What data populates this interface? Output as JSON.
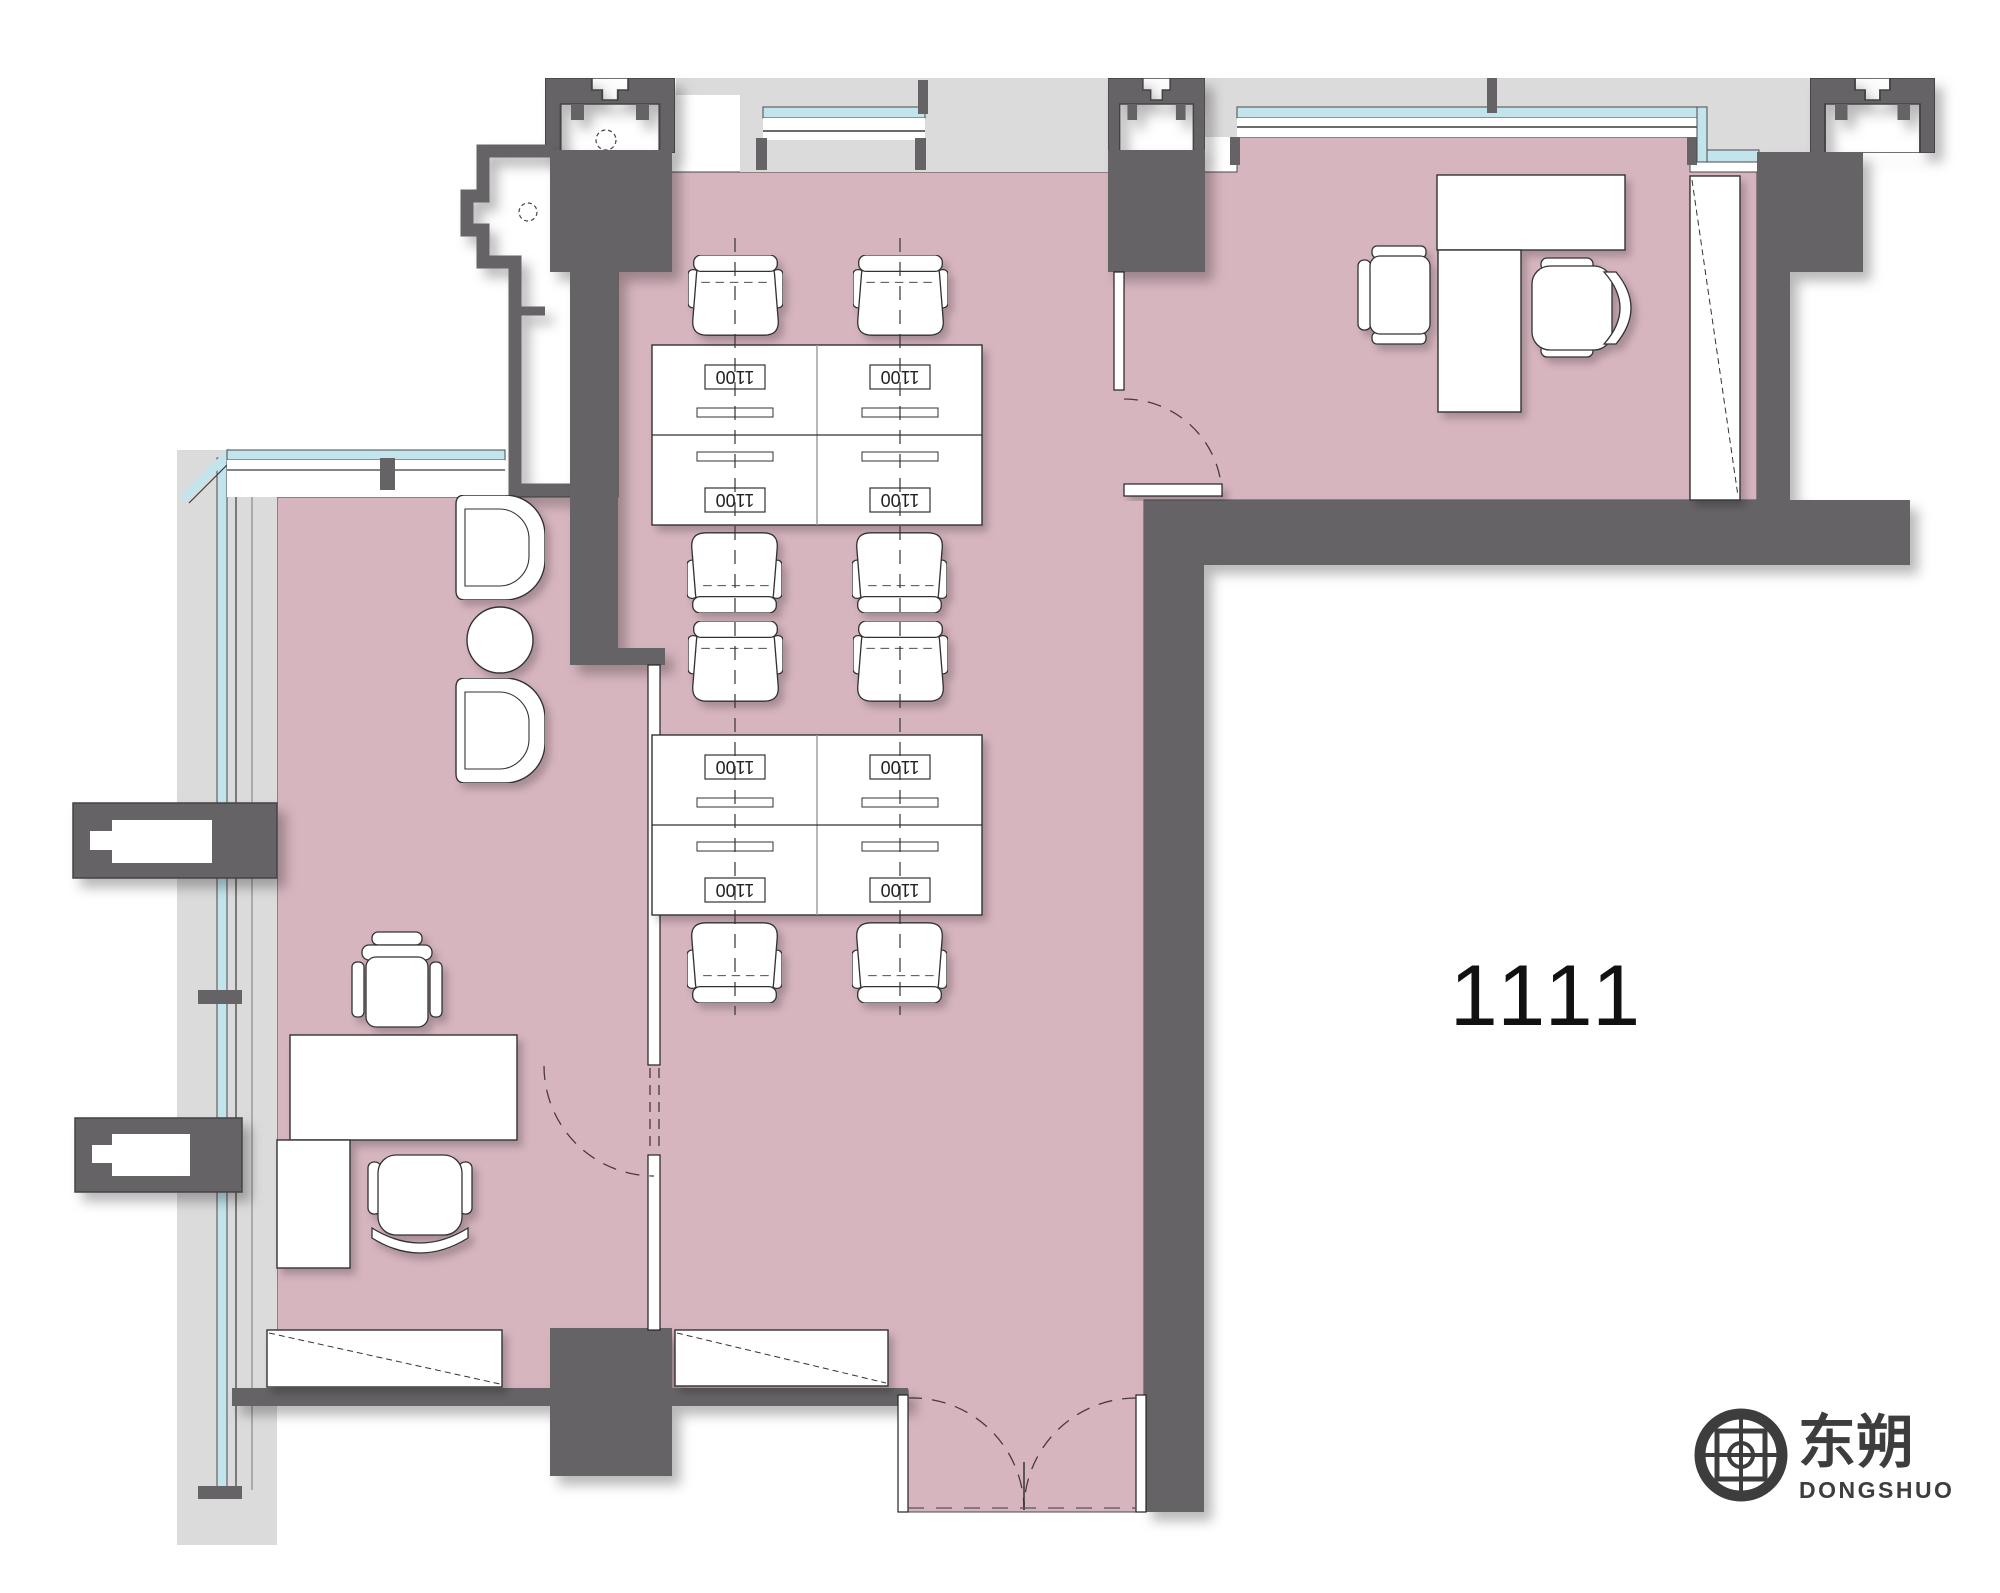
{
  "drawing": {
    "type": "architectural-floor-plan",
    "room": {
      "number_label": "1111"
    },
    "desks": {
      "labels": [
        "1100",
        "1100",
        "1100",
        "1100",
        "1100",
        "1100",
        "1100",
        "1100"
      ]
    },
    "logo": {
      "name_cn": "东朔",
      "name_en": "DONGSHUO"
    },
    "colors": {
      "floor_pink": "#d7b5bf",
      "wall_gray": "#666366",
      "slab_gray": "#dcdbdc",
      "glazing_cyan": "#c3e4ec",
      "line_dark": "#3a3a3a",
      "furniture_fill": "#ffffff",
      "logo_dark": "#3d3d3d",
      "shadow": "rgba(0,0,0,0.28)"
    }
  }
}
